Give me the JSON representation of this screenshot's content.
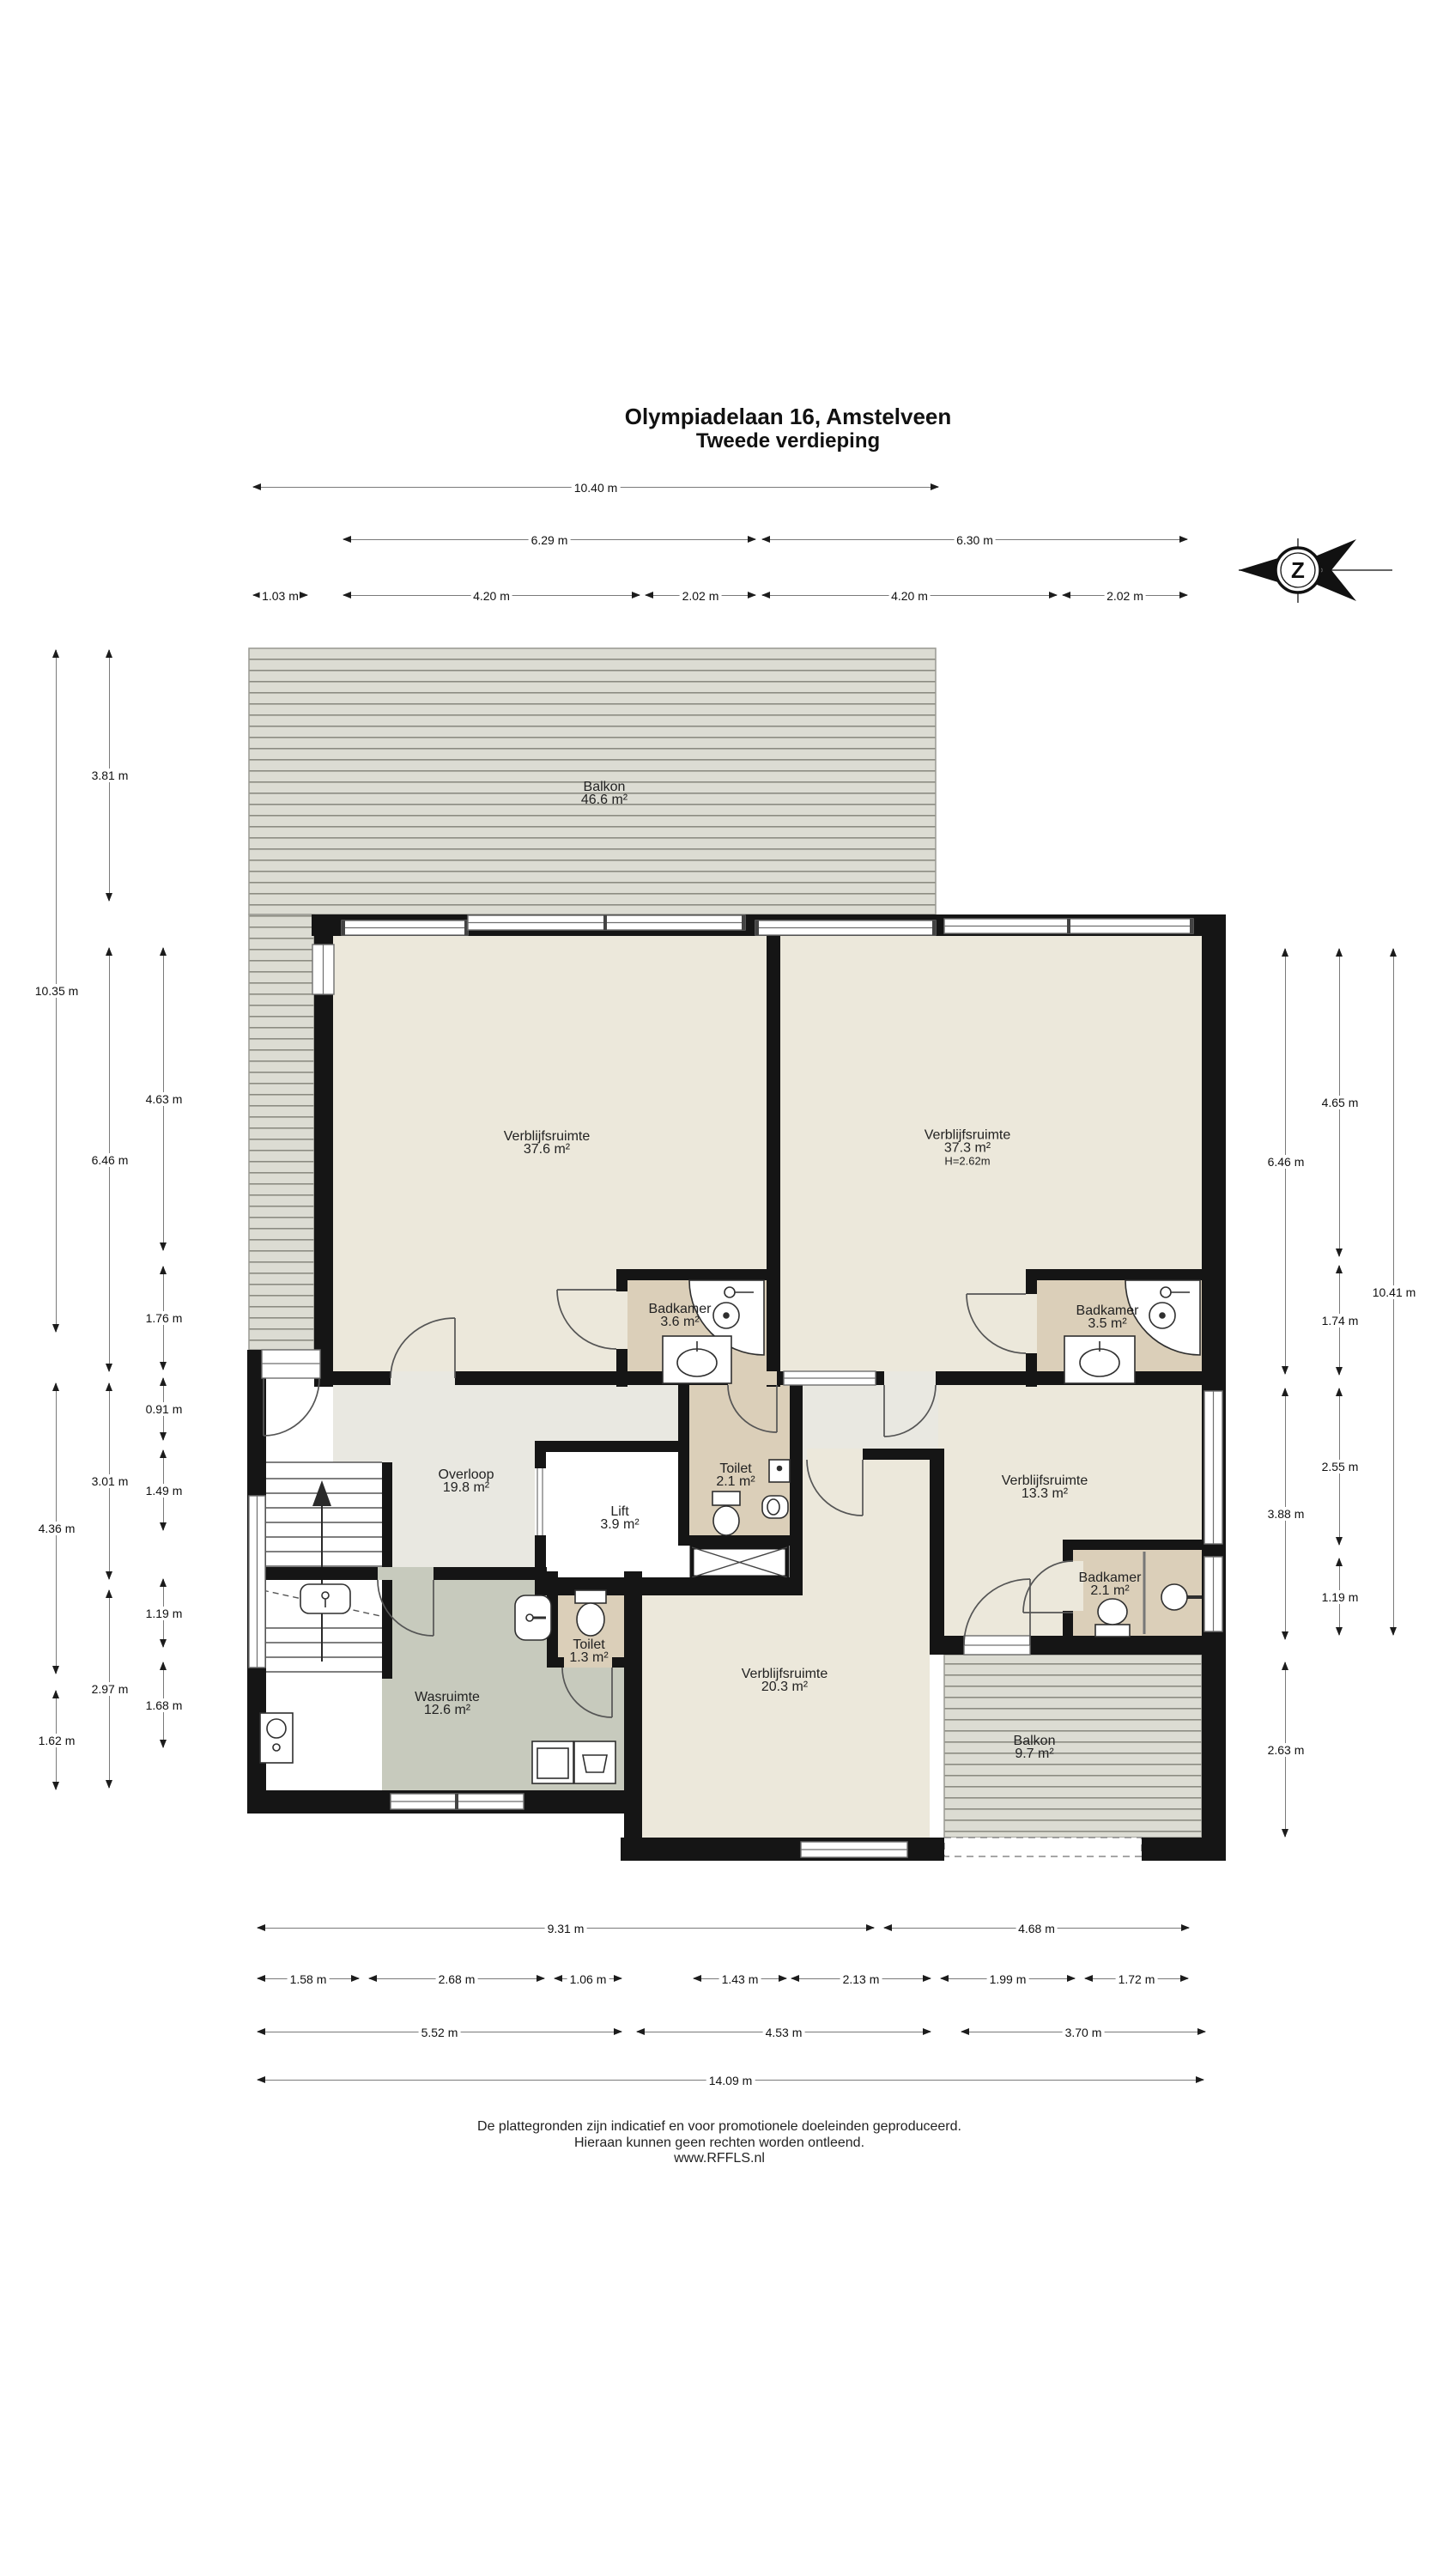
{
  "title": {
    "line1": "Olympiadelaan 16, Amstelveen",
    "line2": "Tweede verdieping"
  },
  "compass": {
    "letter": "Z"
  },
  "rooms": {
    "balkon_boven": {
      "name": "Balkon",
      "area": "46.6 m²"
    },
    "verblijfsruimte_links": {
      "name": "Verblijfsruimte",
      "area": "37.6 m²"
    },
    "verblijfsruimte_rechts": {
      "name": "Verblijfsruimte",
      "area": "37.3 m²",
      "ceiling": "H=2.62m"
    },
    "badkamer_links": {
      "name": "Badkamer",
      "area": "3.6 m²"
    },
    "badkamer_rechts": {
      "name": "Badkamer",
      "area": "3.5 m²"
    },
    "overloop": {
      "name": "Overloop",
      "area": "19.8 m²"
    },
    "lift": {
      "name": "Lift",
      "area": "3.9 m²"
    },
    "toilet_midden": {
      "name": "Toilet",
      "area": "2.1 m²"
    },
    "verblijfsruimte_midden": {
      "name": "Verblijfsruimte",
      "area": "13.3 m²"
    },
    "badkamer_midden": {
      "name": "Badkamer",
      "area": "2.1 m²"
    },
    "toilet_links": {
      "name": "Toilet",
      "area": "1.3 m²"
    },
    "wasruimte": {
      "name": "Wasruimte",
      "area": "12.6 m²"
    },
    "verblijfsruimte_onder": {
      "name": "Verblijfsruimte",
      "area": "20.3 m²"
    },
    "balkon_onder": {
      "name": "Balkon",
      "area": "9.7 m²"
    }
  },
  "dimensions": {
    "top": [
      "10.40 m",
      "6.29 m",
      "6.30 m",
      "1.03 m",
      "4.20 m",
      "2.02 m",
      "4.20 m",
      "2.02 m"
    ],
    "left": [
      "10.35 m",
      "4.36 m",
      "1.62 m",
      "3.81 m",
      "6.46 m",
      "3.01 m",
      "2.97 m",
      "4.63 m",
      "1.76 m",
      "0.91 m",
      "1.49 m",
      "1.19 m",
      "1.68 m"
    ],
    "right": [
      "6.46 m",
      "3.88 m",
      "2.63 m",
      "4.65 m",
      "1.74 m",
      "2.55 m",
      "1.19 m",
      "10.41 m"
    ],
    "bottom": [
      "9.31 m",
      "4.68 m",
      "1.58 m",
      "2.68 m",
      "1.06 m",
      "1.43 m",
      "2.13 m",
      "1.99 m",
      "1.72 m",
      "5.52 m",
      "4.53 m",
      "3.70 m",
      "14.09 m"
    ]
  },
  "footer": {
    "line1": "De plattegronden zijn indicatief en voor promotionele doeleinden geproduceerd.",
    "line2": "Hieraan kunnen geen rechten worden ontleend.",
    "line3": "www.RFFLS.nl"
  },
  "colors": {
    "wall": "#151515",
    "room": "#ece8db",
    "bathroom": "#dbcfb9",
    "hall": "#e9e8e1",
    "utility": "#c7cabd",
    "deck": "#dcdcd3"
  }
}
